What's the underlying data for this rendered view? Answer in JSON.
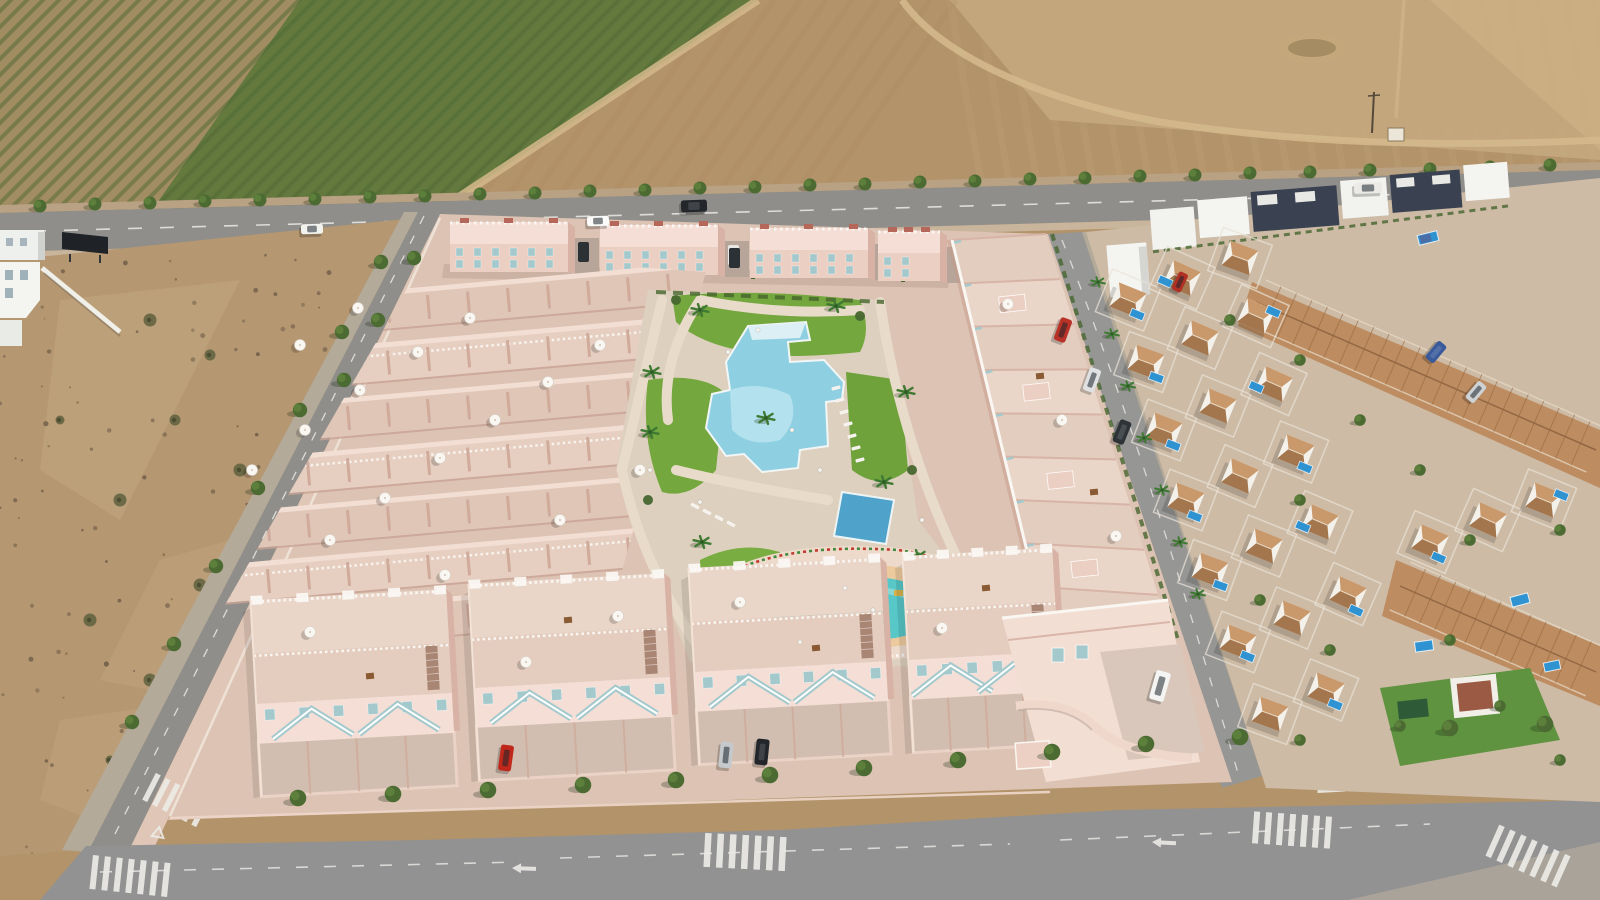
{
  "meta": {
    "description": "aerial drone photograph of a new-build residential development render (pink townhouses with communal pools) surrounded by farmland, an empty plot and an existing villa neighbourhood",
    "width": 1600,
    "height": 900
  },
  "palette": {
    "fieldBrown": "#b3936a",
    "fieldLight": "#c3a67c",
    "fieldLighter": "#cbae82",
    "trackTan": "#d4b98c",
    "orchTan": "#a28c62",
    "orchGreen": "#64793e",
    "rowGreen": "#4e6a33",
    "asphalt": "#8f8e8a",
    "asphalt2": "#969694",
    "sidewalk": "#b3aa9a",
    "pinkWalk": "#e0c6b6",
    "dirtLot": "#b59771",
    "speck": "#57483a",
    "treeGreen": "#4c6b33",
    "treeLight": "#5d7f3c",
    "palmGreen": "#3f7a33",
    "hedge": "#47662f",
    "lawn": "#74a73d",
    "lawn2": "#79ad42",
    "pinkBase": "#dcc3b3",
    "wallLight": "#f4ded5",
    "wallMid": "#eccfc3",
    "wallShade": "#d8b3a5",
    "wallDark": "#c79a8a",
    "floorWarm": "#e4cdbf",
    "whiteTrim": "#faf7f3",
    "teal": "#a3c9cd",
    "redAccent": "#b5685a",
    "poolMain": "#8ed0e2",
    "poolLight": "#b7e2ee",
    "poolDeep": "#4fa3cb",
    "kidsWater": "#57c7c7",
    "kidsLight": "#8fd9d6",
    "sand": "#ecca9e",
    "deck": "#eedacb",
    "pathTan": "#e8dbc9",
    "villaWhite": "#f3f1ea",
    "roofTerra": "#bd8c60",
    "roofDark": "#a3764e",
    "poolBlue": "#2f93d2",
    "navy": "#3a4150",
    "gLight": "#cdbba6",
    "marking": "#eceae6"
  },
  "scene": {
    "avenue_trees": [
      [
        40,
        206
      ],
      [
        95,
        204
      ],
      [
        150,
        203
      ],
      [
        205,
        201
      ],
      [
        260,
        200
      ],
      [
        315,
        199
      ],
      [
        370,
        197
      ],
      [
        425,
        196
      ],
      [
        480,
        194
      ],
      [
        535,
        193
      ],
      [
        590,
        191
      ],
      [
        645,
        190
      ],
      [
        700,
        188
      ],
      [
        755,
        187
      ],
      [
        810,
        185
      ],
      [
        865,
        184
      ],
      [
        920,
        182
      ],
      [
        975,
        181
      ],
      [
        1030,
        179
      ],
      [
        1085,
        178
      ],
      [
        1140,
        176
      ],
      [
        1195,
        175
      ],
      [
        1250,
        173
      ],
      [
        1310,
        172
      ],
      [
        1370,
        170
      ],
      [
        1430,
        169
      ],
      [
        1490,
        167
      ],
      [
        1550,
        165
      ]
    ],
    "avenue_palms": [
      [
        1352,
        205
      ],
      [
        1408,
        202
      ],
      [
        1462,
        200
      ],
      [
        1516,
        198
      ],
      [
        1572,
        196
      ]
    ],
    "left_road_trees": [
      [
        381,
        262
      ],
      [
        342,
        332
      ],
      [
        300,
        410
      ],
      [
        258,
        488
      ],
      [
        216,
        566
      ],
      [
        174,
        644
      ],
      [
        132,
        722
      ],
      [
        414,
        258
      ],
      [
        378,
        320
      ],
      [
        344,
        380
      ]
    ],
    "bottom_road_trees": [
      [
        298,
        798
      ],
      [
        393,
        794
      ],
      [
        488,
        790
      ],
      [
        583,
        785
      ],
      [
        676,
        780
      ],
      [
        770,
        775
      ],
      [
        864,
        768
      ],
      [
        958,
        760
      ],
      [
        1052,
        752
      ],
      [
        1146,
        744
      ],
      [
        1240,
        737
      ],
      [
        1450,
        728
      ],
      [
        1545,
        724
      ]
    ],
    "right_street_palms": [
      [
        1098,
        282
      ],
      [
        1112,
        334
      ],
      [
        1128,
        386
      ],
      [
        1144,
        438
      ],
      [
        1162,
        490
      ],
      [
        1180,
        542
      ],
      [
        1198,
        594
      ]
    ],
    "nbhd_trees": [
      [
        1300,
        360
      ],
      [
        1360,
        420
      ],
      [
        1300,
        500
      ],
      [
        1420,
        470
      ],
      [
        1470,
        540
      ],
      [
        1260,
        600
      ],
      [
        1330,
        650
      ],
      [
        1450,
        640
      ],
      [
        1560,
        530
      ],
      [
        1300,
        740
      ],
      [
        1400,
        726
      ],
      [
        1500,
        706
      ],
      [
        1560,
        760
      ],
      [
        1230,
        320
      ]
    ],
    "lot_bushes": [
      [
        150,
        320
      ],
      [
        210,
        355
      ],
      [
        175,
        420
      ],
      [
        240,
        470
      ],
      [
        120,
        500
      ],
      [
        260,
        540
      ],
      [
        200,
        585
      ],
      [
        300,
        610
      ],
      [
        90,
        620
      ],
      [
        320,
        660
      ],
      [
        150,
        680
      ],
      [
        260,
        720
      ],
      [
        340,
        740
      ],
      [
        110,
        760
      ],
      [
        380,
        700
      ],
      [
        60,
        420
      ]
    ],
    "garden_palms": [
      [
        700,
        310
      ],
      [
        836,
        306
      ],
      [
        766,
        418
      ],
      [
        650,
        432
      ],
      [
        702,
        542
      ],
      [
        760,
        600
      ],
      [
        906,
        392
      ],
      [
        918,
        556
      ],
      [
        884,
        482
      ],
      [
        652,
        372
      ]
    ],
    "garden_bushes": [
      [
        676,
        300
      ],
      [
        860,
        316
      ],
      [
        912,
        470
      ],
      [
        700,
        636
      ],
      [
        940,
        600
      ],
      [
        648,
        500
      ]
    ],
    "umbrellas": [
      [
        300,
        345
      ],
      [
        358,
        308
      ],
      [
        252,
        470
      ],
      [
        305,
        430
      ],
      [
        360,
        390
      ],
      [
        418,
        352
      ],
      [
        470,
        318
      ],
      [
        330,
        540
      ],
      [
        385,
        498
      ],
      [
        440,
        458
      ],
      [
        495,
        420
      ],
      [
        548,
        382
      ],
      [
        600,
        345
      ],
      [
        445,
        575
      ],
      [
        560,
        520
      ],
      [
        640,
        470
      ],
      [
        310,
        632
      ],
      [
        526,
        662
      ],
      [
        618,
        616
      ],
      [
        740,
        602
      ],
      [
        942,
        628
      ],
      [
        1008,
        304
      ],
      [
        1062,
        420
      ],
      [
        1116,
        536
      ]
    ],
    "tables": [
      [
        370,
        676
      ],
      [
        568,
        620
      ],
      [
        816,
        648
      ],
      [
        986,
        588
      ],
      [
        1040,
        376
      ],
      [
        1094,
        492
      ]
    ],
    "left_rows": {
      "x0": 212,
      "x1": 716,
      "y0": 308,
      "rows": 7,
      "dy": 52,
      "m": -0.088,
      "rot": -5
    },
    "back_row_blocks": [
      {
        "x": 450,
        "y": 222,
        "w": 118,
        "cars": [
          "#2c3136"
        ]
      },
      {
        "x": 600,
        "y": 225,
        "w": 118,
        "cars": [
          "#e8e7e3",
          "#2c3136"
        ]
      },
      {
        "x": 750,
        "y": 228,
        "w": 118,
        "cars": [
          "#30353b"
        ]
      },
      {
        "x": 878,
        "y": 231,
        "w": 62,
        "cars": []
      }
    ],
    "bottom_row_blocks": [
      {
        "x": 250,
        "y": 592,
        "w": 196
      },
      {
        "x": 468,
        "y": 576,
        "w": 196
      },
      {
        "x": 688,
        "y": 560,
        "w": 192
      },
      {
        "x": 902,
        "y": 548,
        "w": 150
      }
    ],
    "wing": {
      "l0": [
        952,
        240
      ],
      "l1": [
        1046,
        630
      ],
      "r0": [
        1046,
        234
      ],
      "r1": [
        1172,
        640
      ],
      "n": 9
    },
    "crosswalks": [
      {
        "x": 130,
        "y": 876,
        "a": 6,
        "n": 7,
        "w": 6,
        "l": 34,
        "g": 6
      },
      {
        "x": 176,
        "y": 800,
        "a": 27,
        "n": 6,
        "w": 5.5,
        "l": 30,
        "g": 5.5
      },
      {
        "x": 745,
        "y": 852,
        "a": 3,
        "n": 7,
        "w": 6.5,
        "l": 34,
        "g": 6
      },
      {
        "x": 1292,
        "y": 830,
        "a": 4,
        "n": 7,
        "w": 6,
        "l": 32,
        "g": 6
      },
      {
        "x": 1528,
        "y": 856,
        "a": 24,
        "n": 7,
        "w": 6,
        "l": 34,
        "g": 6
      },
      {
        "x": 1330,
        "y": 762,
        "a": 87,
        "n": 6,
        "w": 5.5,
        "l": 28,
        "g": 5.5
      }
    ],
    "cars": [
      [
        312,
        229,
        22,
        10,
        -2,
        "#f2f2ee"
      ],
      [
        598,
        221,
        22,
        10,
        -2,
        "#fbfbf9"
      ],
      [
        694,
        206,
        26,
        12,
        -2,
        "#23272c"
      ],
      [
        1368,
        188,
        28,
        11,
        -2,
        "#eceae6"
      ],
      [
        506,
        758,
        13,
        26,
        8,
        "#c0281c"
      ],
      [
        726,
        755,
        13,
        26,
        6,
        "#c6c9cc"
      ],
      [
        762,
        752,
        13,
        26,
        6,
        "#22262b"
      ],
      [
        1160,
        686,
        15,
        30,
        16,
        "#f4f4f2"
      ],
      [
        1063,
        330,
        12,
        24,
        20,
        "#b83227"
      ],
      [
        1092,
        380,
        12,
        24,
        20,
        "#dfe1e2"
      ],
      [
        1122,
        432,
        12,
        24,
        22,
        "#2e3338"
      ],
      [
        1436,
        352,
        11,
        22,
        40,
        "#3a5a9c"
      ],
      [
        1476,
        392,
        11,
        22,
        40,
        "#cfd2d4"
      ],
      [
        1180,
        282,
        10,
        20,
        25,
        "#b03024"
      ]
    ],
    "villas": [
      [
        1128,
        300,
        22,
        14,
        10
      ],
      [
        1182,
        278,
        24,
        -14,
        10
      ],
      [
        1240,
        258,
        20,
        0,
        0
      ],
      [
        1146,
        362,
        20,
        15,
        11
      ],
      [
        1200,
        338,
        23,
        0,
        0
      ],
      [
        1256,
        316,
        24,
        14,
        -11
      ],
      [
        1164,
        430,
        21,
        14,
        11
      ],
      [
        1218,
        406,
        22,
        0,
        0
      ],
      [
        1274,
        384,
        24,
        -15,
        10
      ],
      [
        1186,
        500,
        21,
        14,
        12
      ],
      [
        1240,
        476,
        23,
        0,
        0
      ],
      [
        1296,
        452,
        22,
        14,
        11
      ],
      [
        1210,
        570,
        20,
        15,
        11
      ],
      [
        1264,
        546,
        22,
        0,
        0
      ],
      [
        1320,
        522,
        23,
        -14,
        11
      ],
      [
        1238,
        642,
        21,
        14,
        10
      ],
      [
        1292,
        618,
        22,
        0,
        0
      ],
      [
        1348,
        594,
        24,
        14,
        12
      ],
      [
        1270,
        714,
        20,
        0,
        0
      ],
      [
        1326,
        690,
        22,
        14,
        10
      ],
      [
        1430,
        542,
        23,
        14,
        11
      ],
      [
        1488,
        520,
        24,
        0,
        0
      ],
      [
        1544,
        500,
        22,
        14,
        -11
      ]
    ],
    "roof_bands": [
      {
        "p0": [
          1256,
          302
        ],
        "p1": [
          1596,
          450
        ],
        "hw": 24,
        "n": 22
      },
      {
        "p0": [
          1400,
          586
        ],
        "p1": [
          1596,
          672
        ],
        "hw": 26,
        "n": 13
      }
    ],
    "nbhd_pools": [
      [
        1428,
        238,
        20,
        10,
        -14,
        true
      ],
      [
        1520,
        600,
        18,
        10,
        -15,
        false
      ],
      [
        1552,
        666,
        16,
        9,
        -12,
        false
      ],
      [
        1424,
        646,
        18,
        10,
        -8,
        false
      ]
    ],
    "loungers": {
      "rowA": [
        [
          836,
          388
        ],
        [
          840,
          400
        ],
        [
          844,
          412
        ],
        [
          848,
          424
        ],
        [
          852,
          436
        ],
        [
          856,
          448
        ],
        [
          860,
          460
        ]
      ],
      "rotA": -15,
      "rowB": [
        [
          695,
          506
        ],
        [
          707,
          512
        ],
        [
          719,
          518
        ],
        [
          731,
          524
        ]
      ],
      "rotB": 28
    },
    "people": [
      [
        728,
        352
      ],
      [
        792,
        430
      ],
      [
        820,
        470
      ],
      [
        700,
        502
      ],
      [
        873,
        610
      ],
      [
        800,
        642
      ],
      [
        922,
        520
      ],
      [
        845,
        588
      ],
      [
        650,
        470
      ],
      [
        758,
        330
      ]
    ],
    "speckle_count": 150
  }
}
